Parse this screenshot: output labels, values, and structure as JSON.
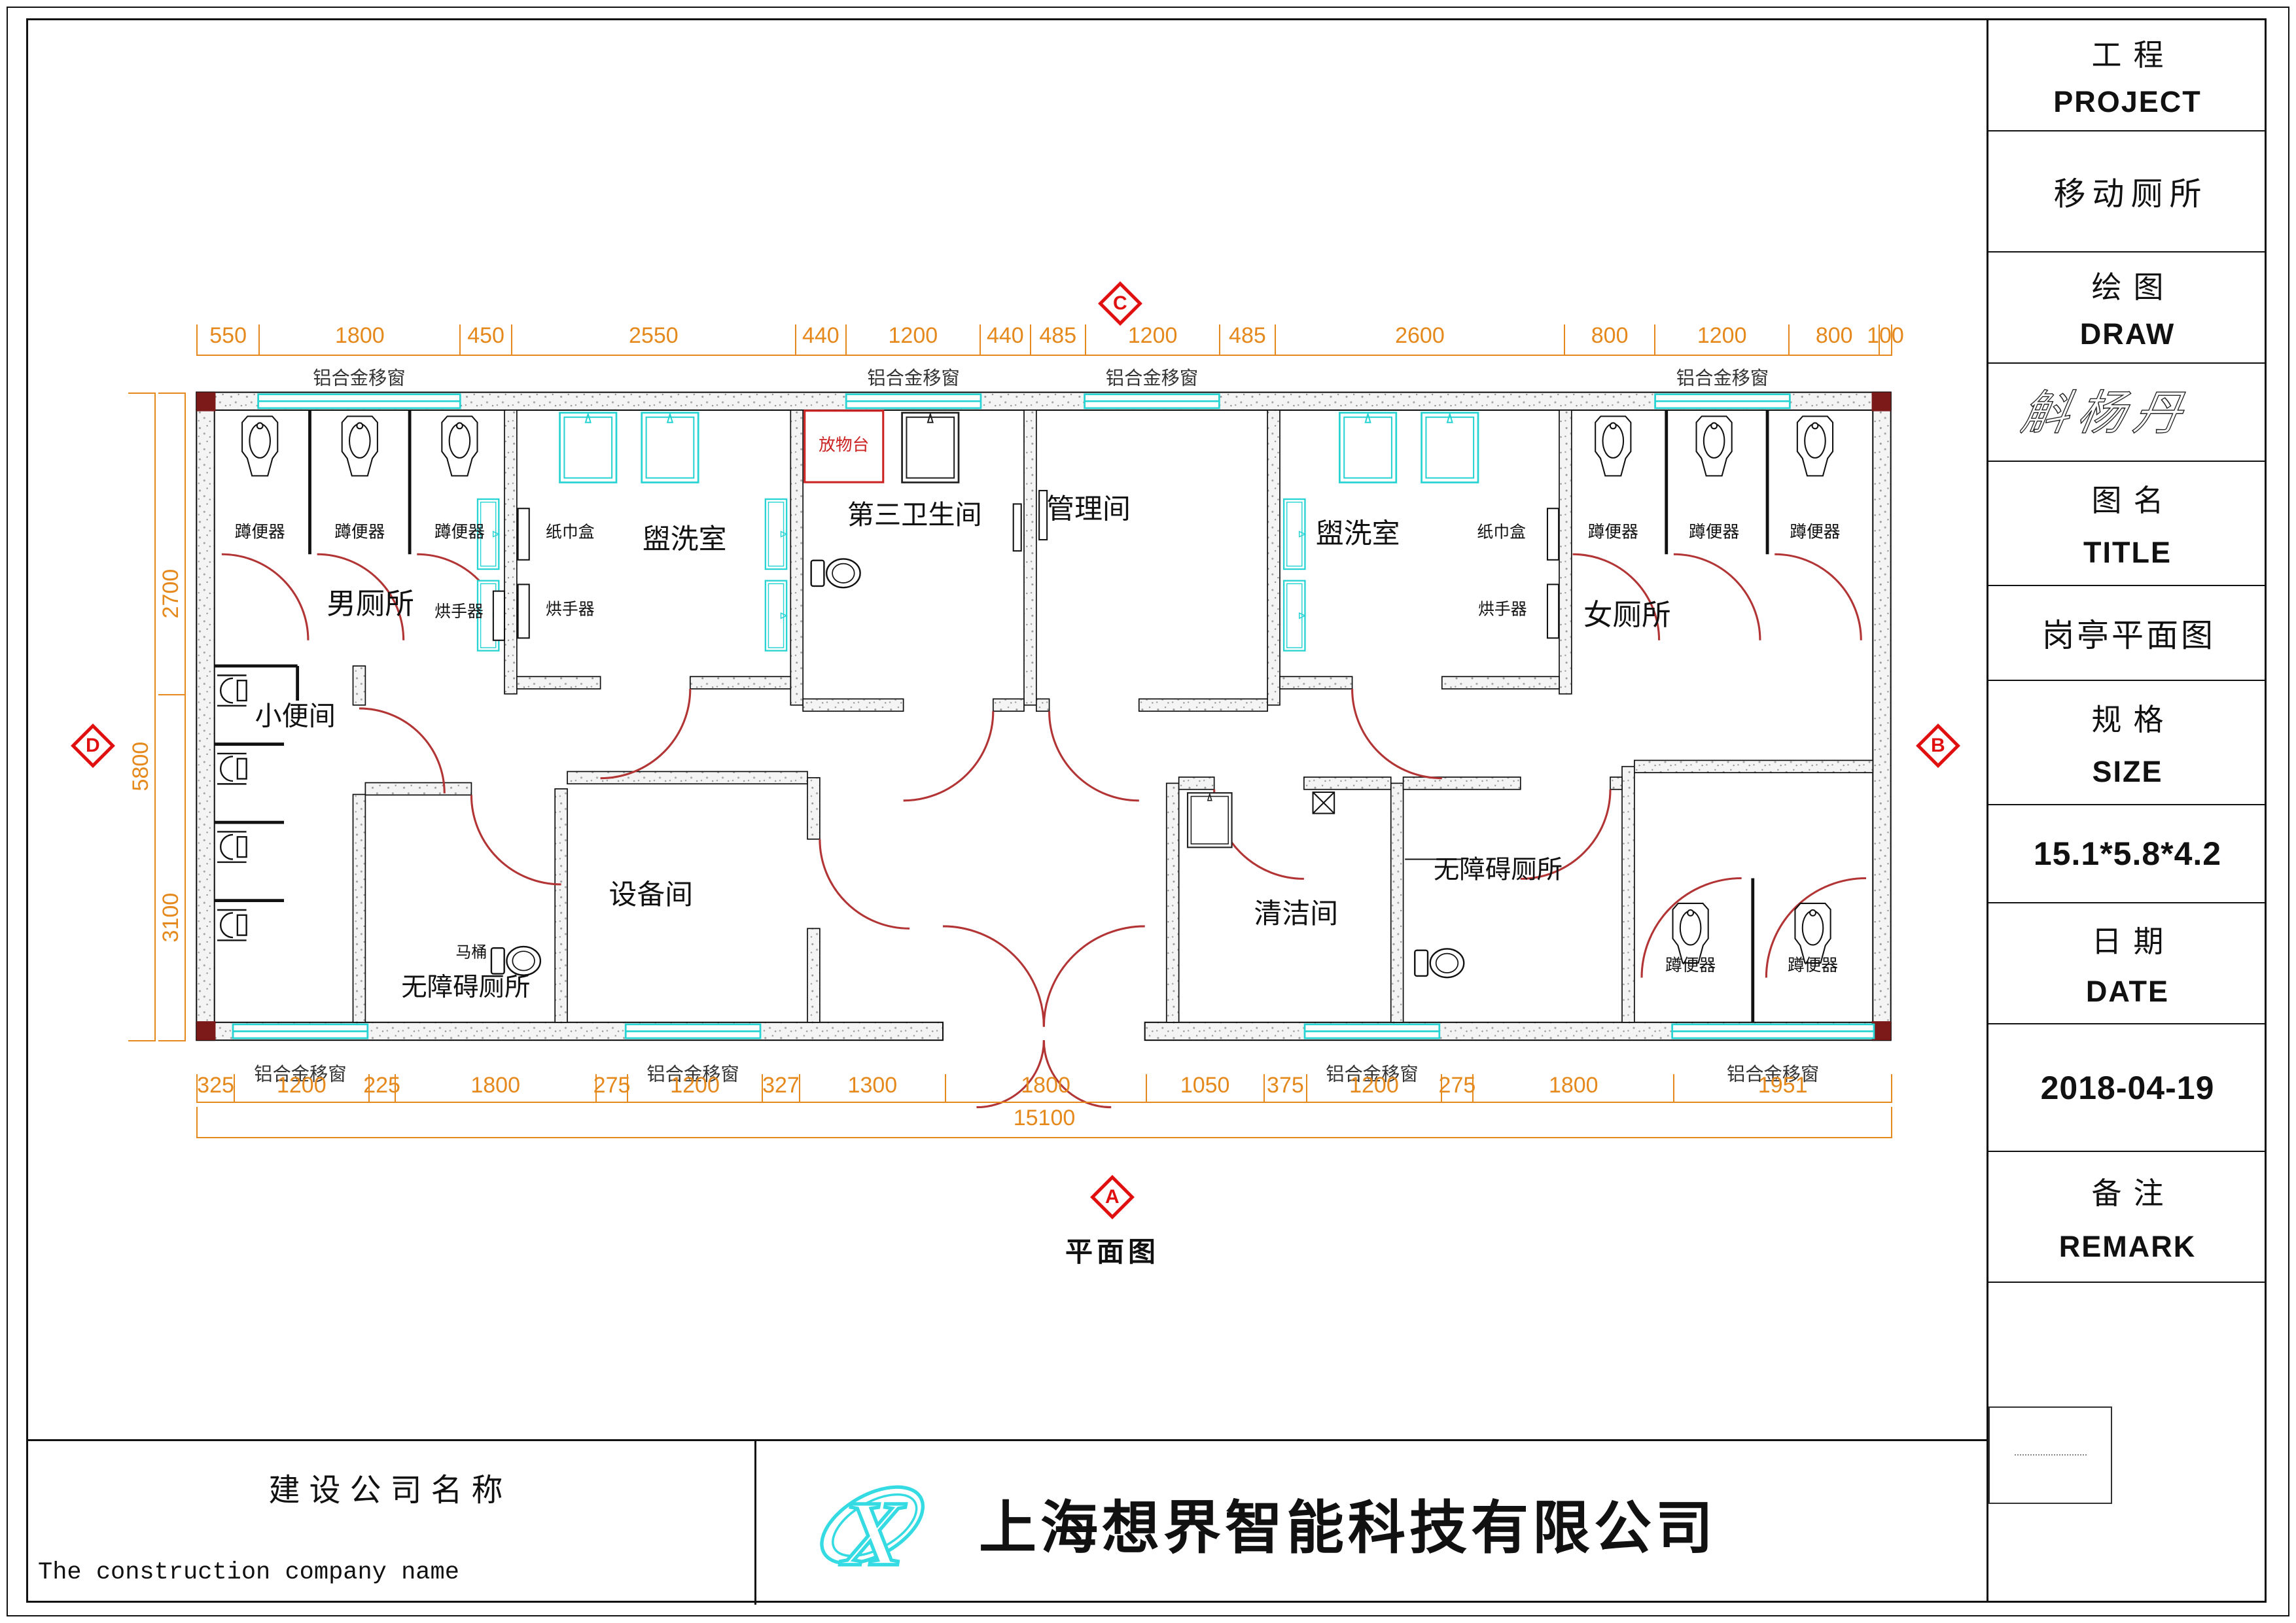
{
  "drawing": {
    "plan_view_label": "平面图",
    "markers": {
      "top": "C",
      "bottom": "A",
      "left": "D",
      "right": "B"
    },
    "dimensions": {
      "top": [
        "550",
        "1800",
        "450",
        "2550",
        "440",
        "1200",
        "440",
        "485",
        "1200",
        "485",
        "2600",
        "800",
        "1200",
        "800",
        "100"
      ],
      "bottom": [
        "325",
        "1200",
        "225",
        "1800",
        "275",
        "1200",
        "327",
        "1300",
        "1800",
        "1050",
        "375",
        "1200",
        "275",
        "1800",
        "1951"
      ],
      "left": [
        "2700",
        "3100"
      ],
      "left_total": "5800",
      "bottom_total": "15100"
    },
    "rooms": {
      "mens_toilet": "男厕所",
      "urinal_room": "小便间",
      "washroom": "盥洗室",
      "third_restroom": "第三卫生间",
      "management_room": "管理间",
      "womens_toilet": "女厕所",
      "equipment_room": "设备间",
      "accessible_toilet": "无障碍厕所",
      "cleaning_room": "清洁间"
    },
    "fixtures": {
      "squat_toilet": "蹲便器",
      "tissue_box": "纸巾盒",
      "hand_dryer": "烘手器",
      "toilet": "马桶",
      "shelf": "放物台",
      "window": "铝合金移窗"
    }
  },
  "title_block": {
    "project_label_zh": "工程",
    "project_label_en": "PROJECT",
    "project_value": "移动厕所",
    "draw_label_zh": "绘图",
    "draw_label_en": "DRAW",
    "draw_signature": "斛杨丹",
    "title_label_zh": "图名",
    "title_label_en": "TITLE",
    "title_value": "岗亭平面图",
    "size_label_zh": "规格",
    "size_label_en": "SIZE",
    "size_value": "15.1*5.8*4.2",
    "date_label_zh": "日期",
    "date_label_en": "DATE",
    "date_value": "2018-04-19",
    "remark_label_zh": "备注",
    "remark_label_en": "REMARK"
  },
  "footer": {
    "company_label_zh": "建设公司名称",
    "company_label_en": "The construction company name",
    "company_name": "上海想界智能科技有限公司"
  },
  "colors": {
    "dimension": "#e5891d",
    "door": "#b23434",
    "marker": "#e01010",
    "window": "#27d3d3",
    "shelf_red": "#cc2222",
    "wall_speckle": "#9a9a9a"
  }
}
